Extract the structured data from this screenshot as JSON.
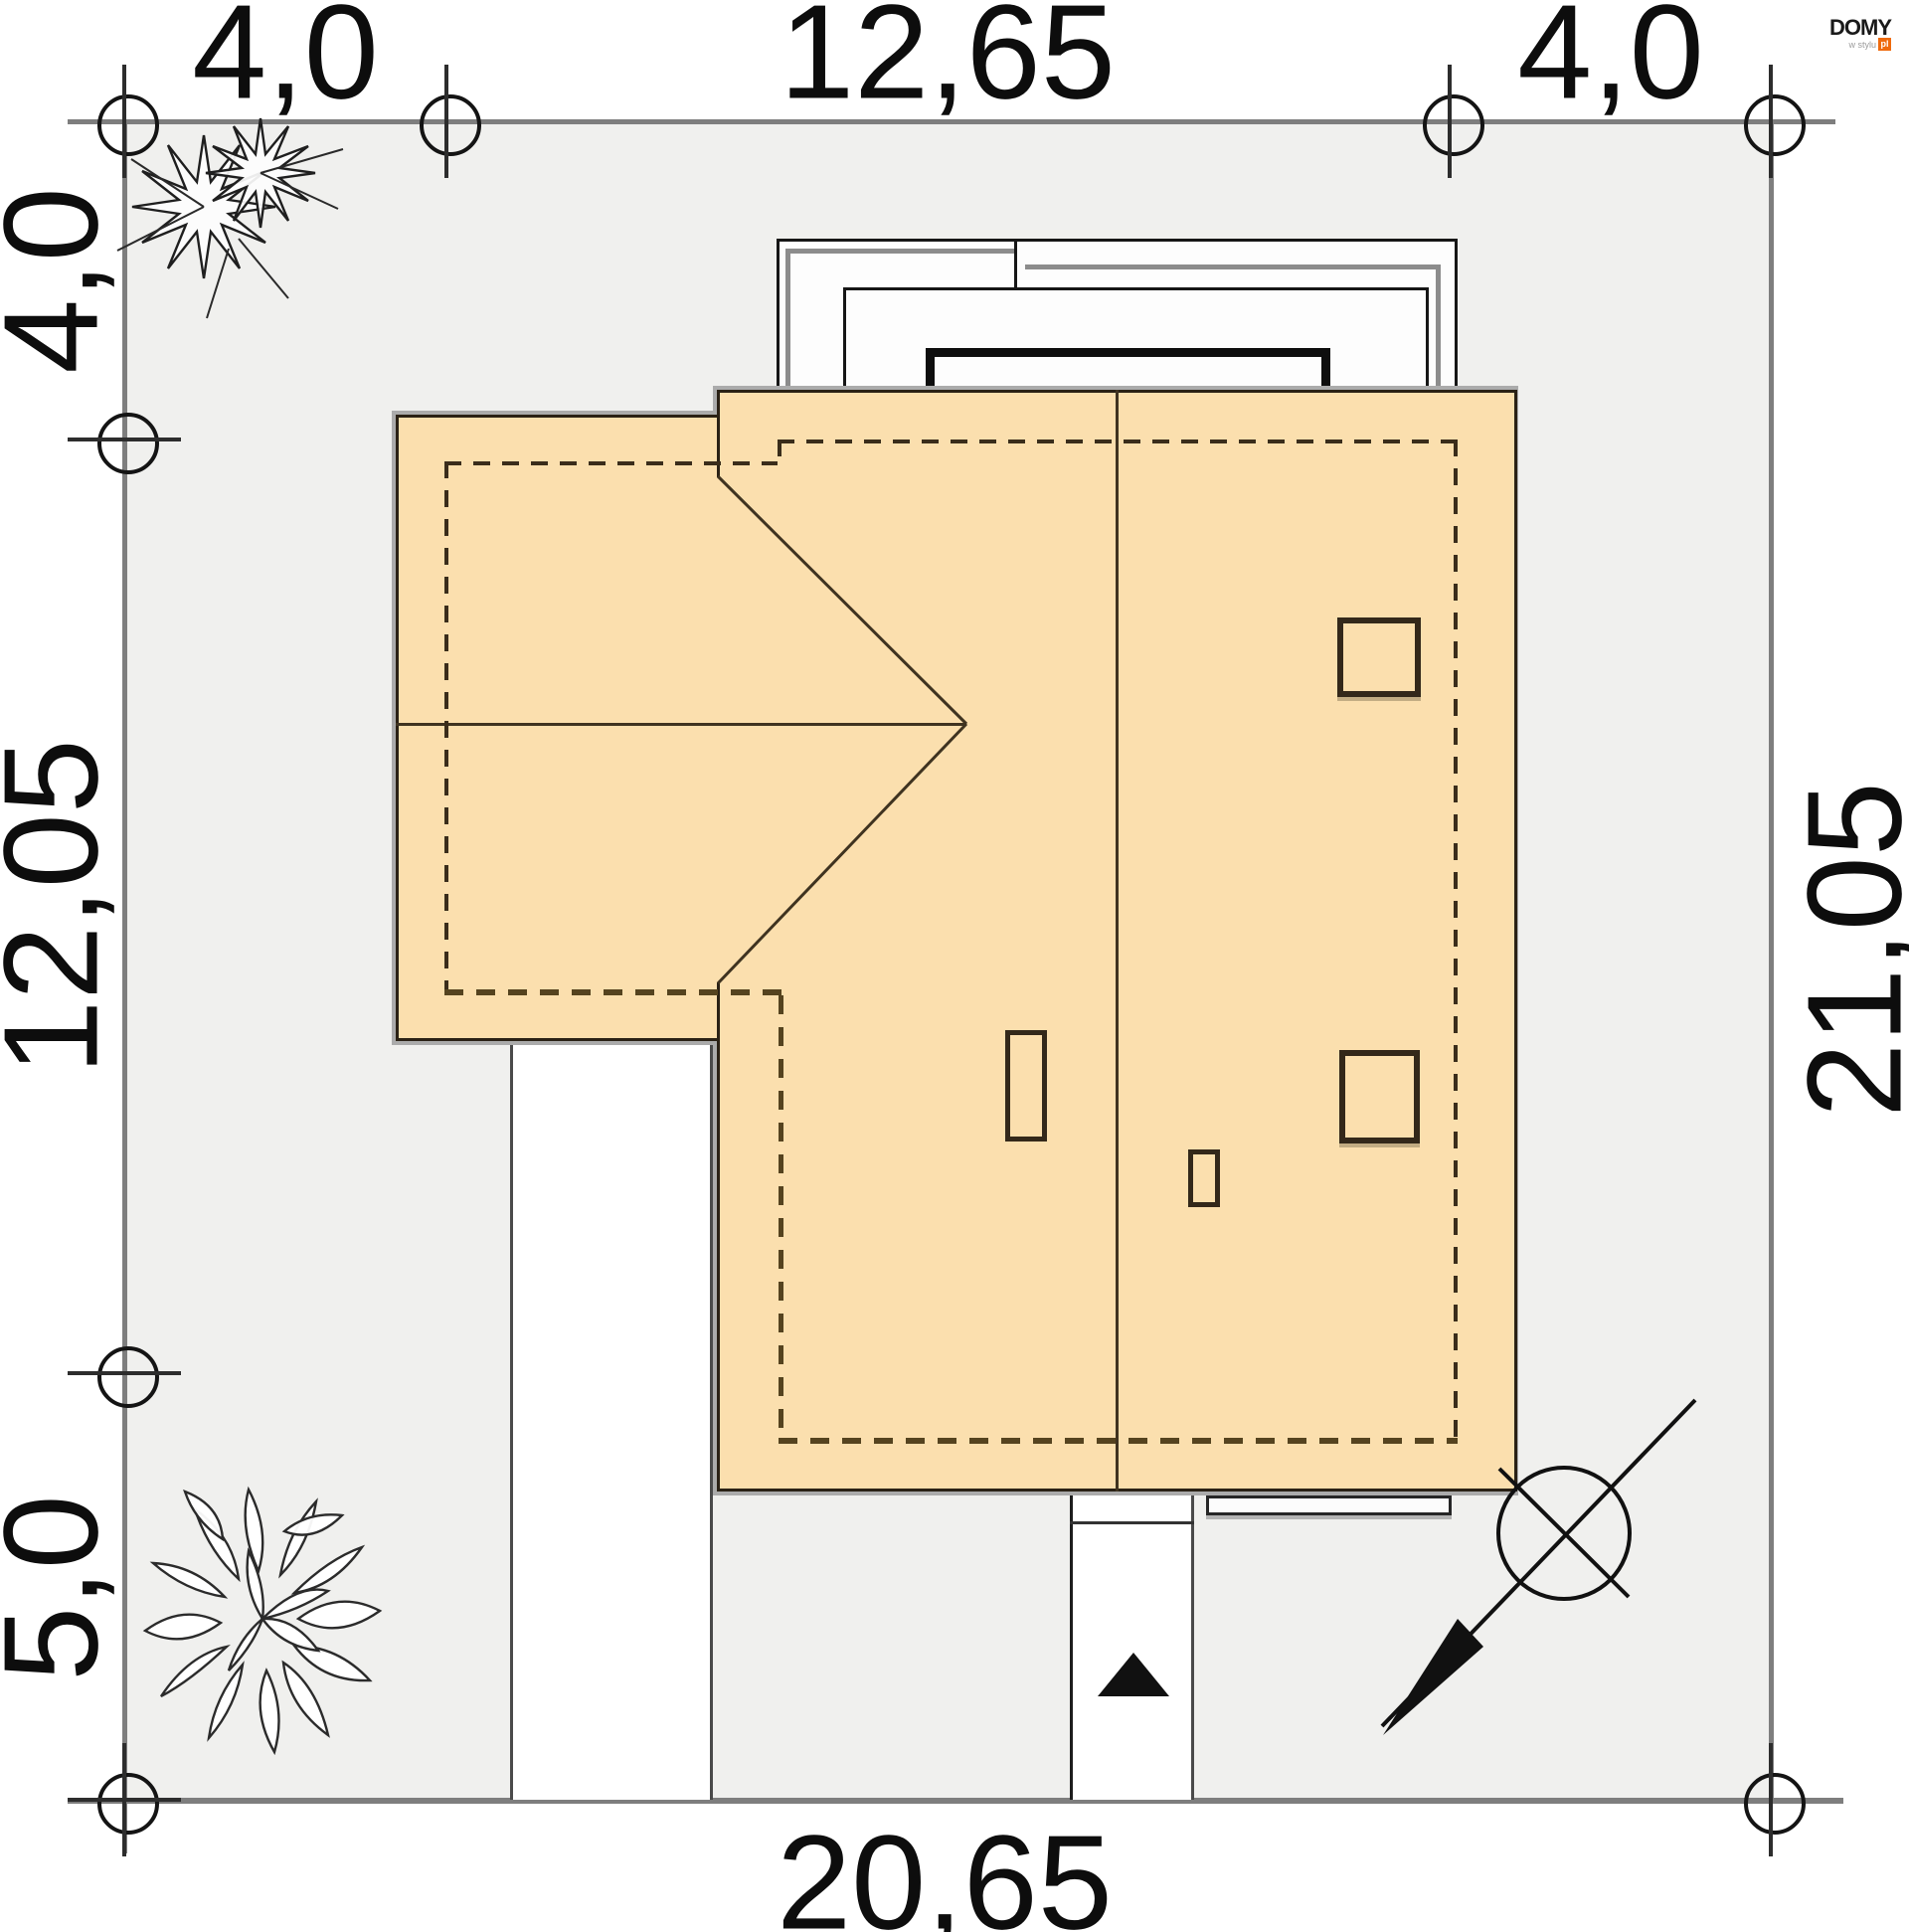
{
  "brand": {
    "name": "DOMY",
    "tagline": "w stylu",
    "tld": "pl",
    "accent_color": "#ef6a0d"
  },
  "site_plan": {
    "type": "house plot plan (roof view)",
    "plot_fill": "#f0f0ee",
    "house_fill": "#fbdfae",
    "dimensions_m": {
      "top_left_setback": "4,0",
      "top_house_width": "12,65",
      "top_right_setback": "4,0",
      "left_top_setback": "4,0",
      "left_house_depth": "12,05",
      "left_bottom_setback": "5,0",
      "right_plot_depth": "21,05",
      "bottom_plot_width": "20,65"
    }
  }
}
